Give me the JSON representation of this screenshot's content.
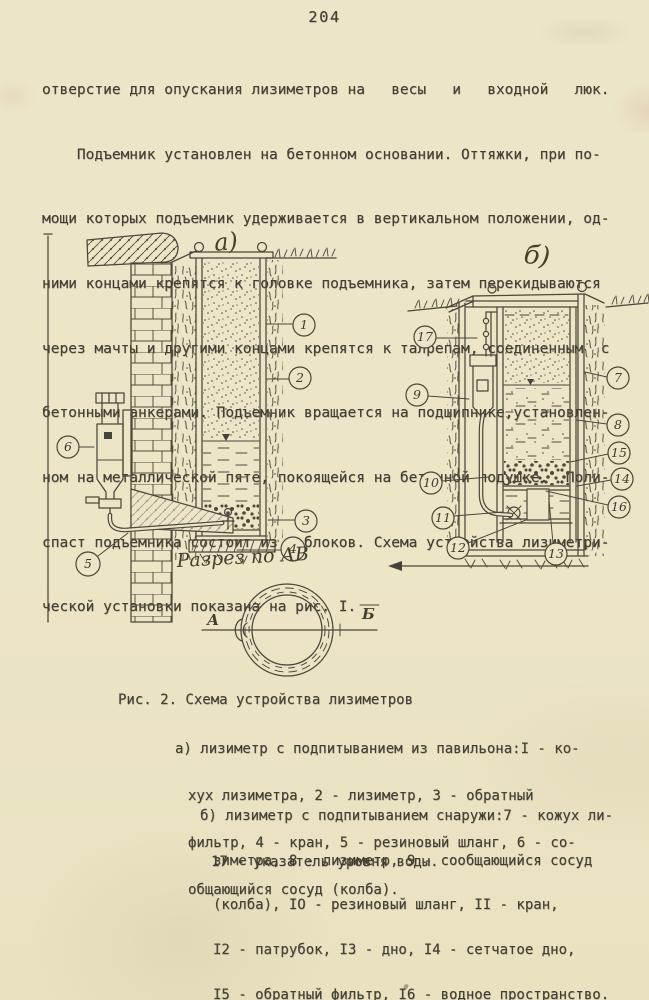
{
  "page": {
    "number": "204"
  },
  "colors": {
    "paper": "#ece5c7",
    "ink": "#413e34",
    "drawing_line": "#4a473b"
  },
  "paragraph": {
    "lines": [
      "отверстие для опускания лизиметров на   весы   и   входной   люк.",
      "    Подъемник установлен на бетонном основании. Оттяжки, при по-",
      "мощи которых подъемник удерживается в вертикальном положении, од-",
      "ними концами крепятся к головке подъемника, затем перекидываются",
      "через мачты и другими концами крепятся к талрепам, соединенным  с",
      "бетонными анкерами. Подъемник вращается на подшипнике,установлен-",
      "ном на металлической пяте, покоящейся на бетонной подушке.  Поли-",
      "спаст подъемника состоит из 4 блоков. Схема устройства лизиметри-",
      "ческой установки показана на рис. I."
    ]
  },
  "figure": {
    "label_a": "а)",
    "label_b": "б)",
    "section_label": "Разрез по АВ",
    "section_left": "А",
    "section_right": "Б",
    "callout_numbers": [
      "1",
      "2",
      "3",
      "4",
      "5",
      "6",
      "7",
      "8",
      "9",
      "10",
      "11",
      "12",
      "13",
      "14",
      "15",
      "16",
      "17"
    ]
  },
  "caption": {
    "title": "Рис. 2. Схема устройства лизиметров",
    "item_a_lines": [
      "а) лизиметр с подпитыванием из павильона:I - ко-",
      "хух лизиметра, 2 - лизиметр, 3 - обратный",
      "фильтр, 4 - кран, 5 - резиновый шланг, 6 - со-",
      "общающийся сосуд (колба)."
    ],
    "item_b_lines": [
      "б) лизиметр с подпитыванием снаружи:7 - кожух ли-",
      "зиметра, 8 - лизиметр, 9 - сообщающийся сосуд",
      "(колба), IО - резиновый шланг, II - кран,",
      "I2 - патрубок, I3 - дно, I4 - сетчатое дно,",
      "I5 - обратный фильтр, I6 - водное пространство."
    ],
    "item_17": "17 - указатель уровня воды."
  }
}
